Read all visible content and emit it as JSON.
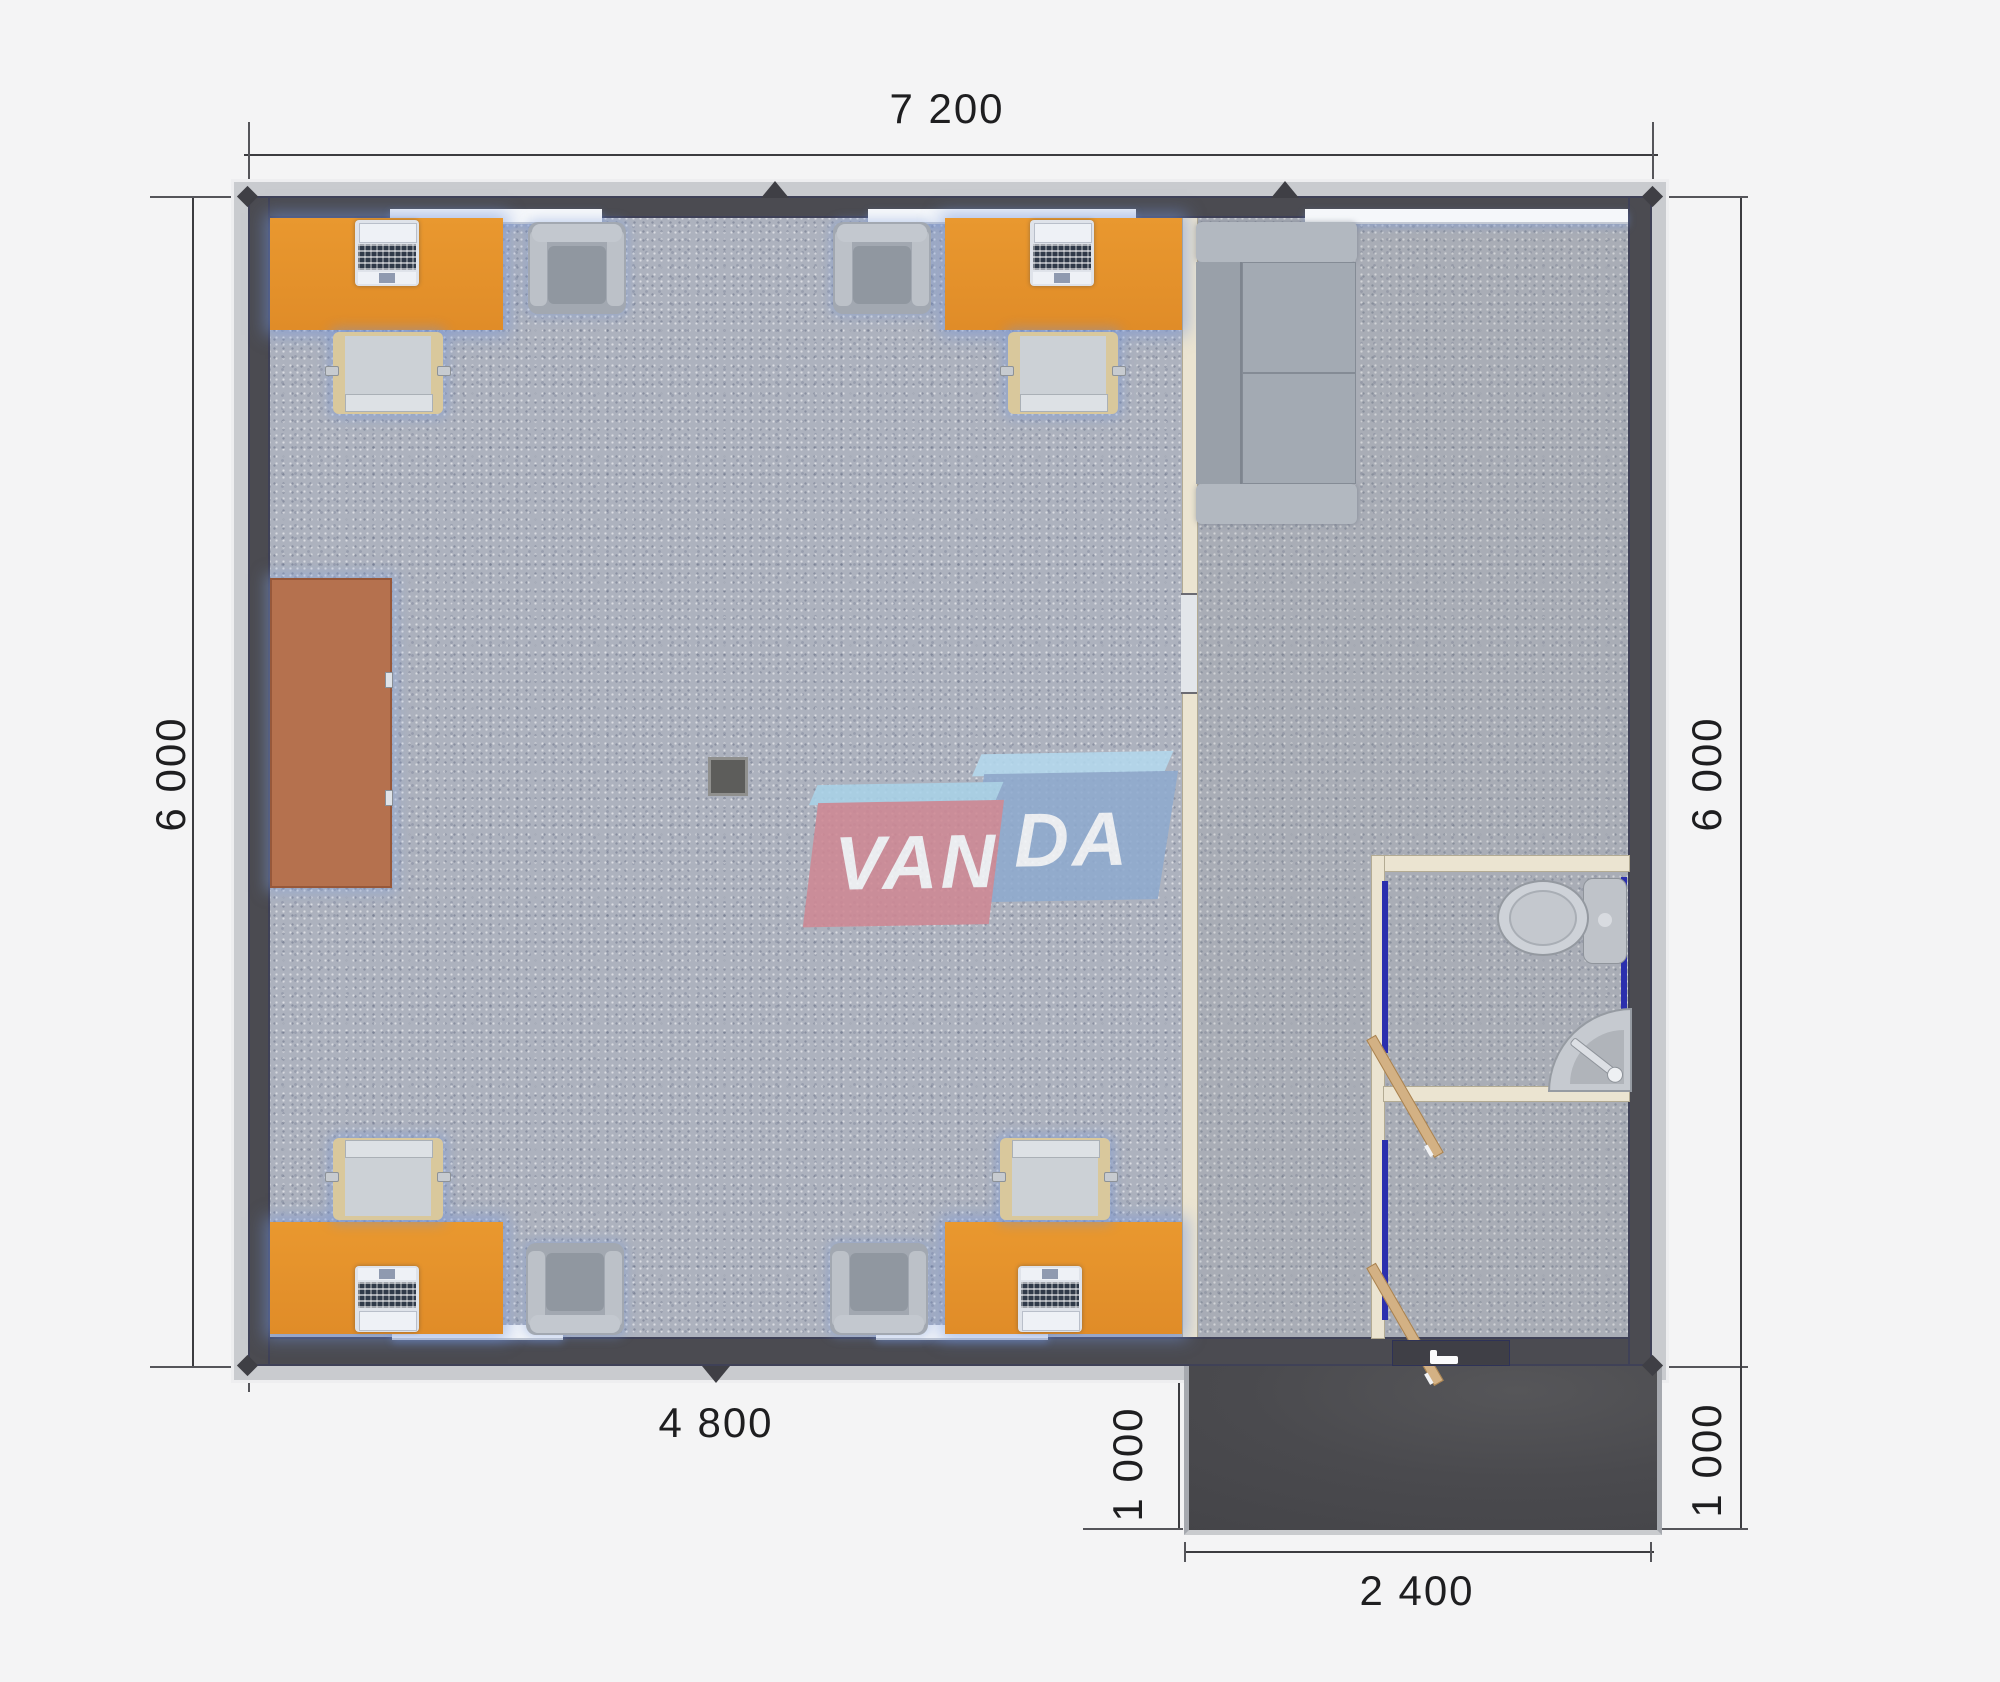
{
  "watermark": {
    "brand": "VANDA",
    "text_left": "VAN",
    "text_right": "DA",
    "red": "#cf8894",
    "blue": "#8fabcf",
    "top_face": "#a9d2e8"
  },
  "dimensions": {
    "top": "7 200",
    "left": "6 000",
    "right": "6 000",
    "bottom_left": "4 800",
    "porch_left": "1 000",
    "porch_bottom": "2 400",
    "porch_right": "1 000"
  },
  "colors": {
    "background": "#f4f4f5",
    "outer_wall": "#4b4b51",
    "roof_edge": "#c9cbcf",
    "floor_carpet": "#adb2be",
    "desk_orange": "#e8962e",
    "cabinet_sienna": "#b5714e",
    "partition_cream": "#ebe4d1",
    "door_frame_blue": "#2b2fae",
    "door_wood": "#d3b184",
    "porch_dark": "#48484c",
    "furniture_gray": "#a2a8b1",
    "dimension_text": "#1e1e20"
  }
}
